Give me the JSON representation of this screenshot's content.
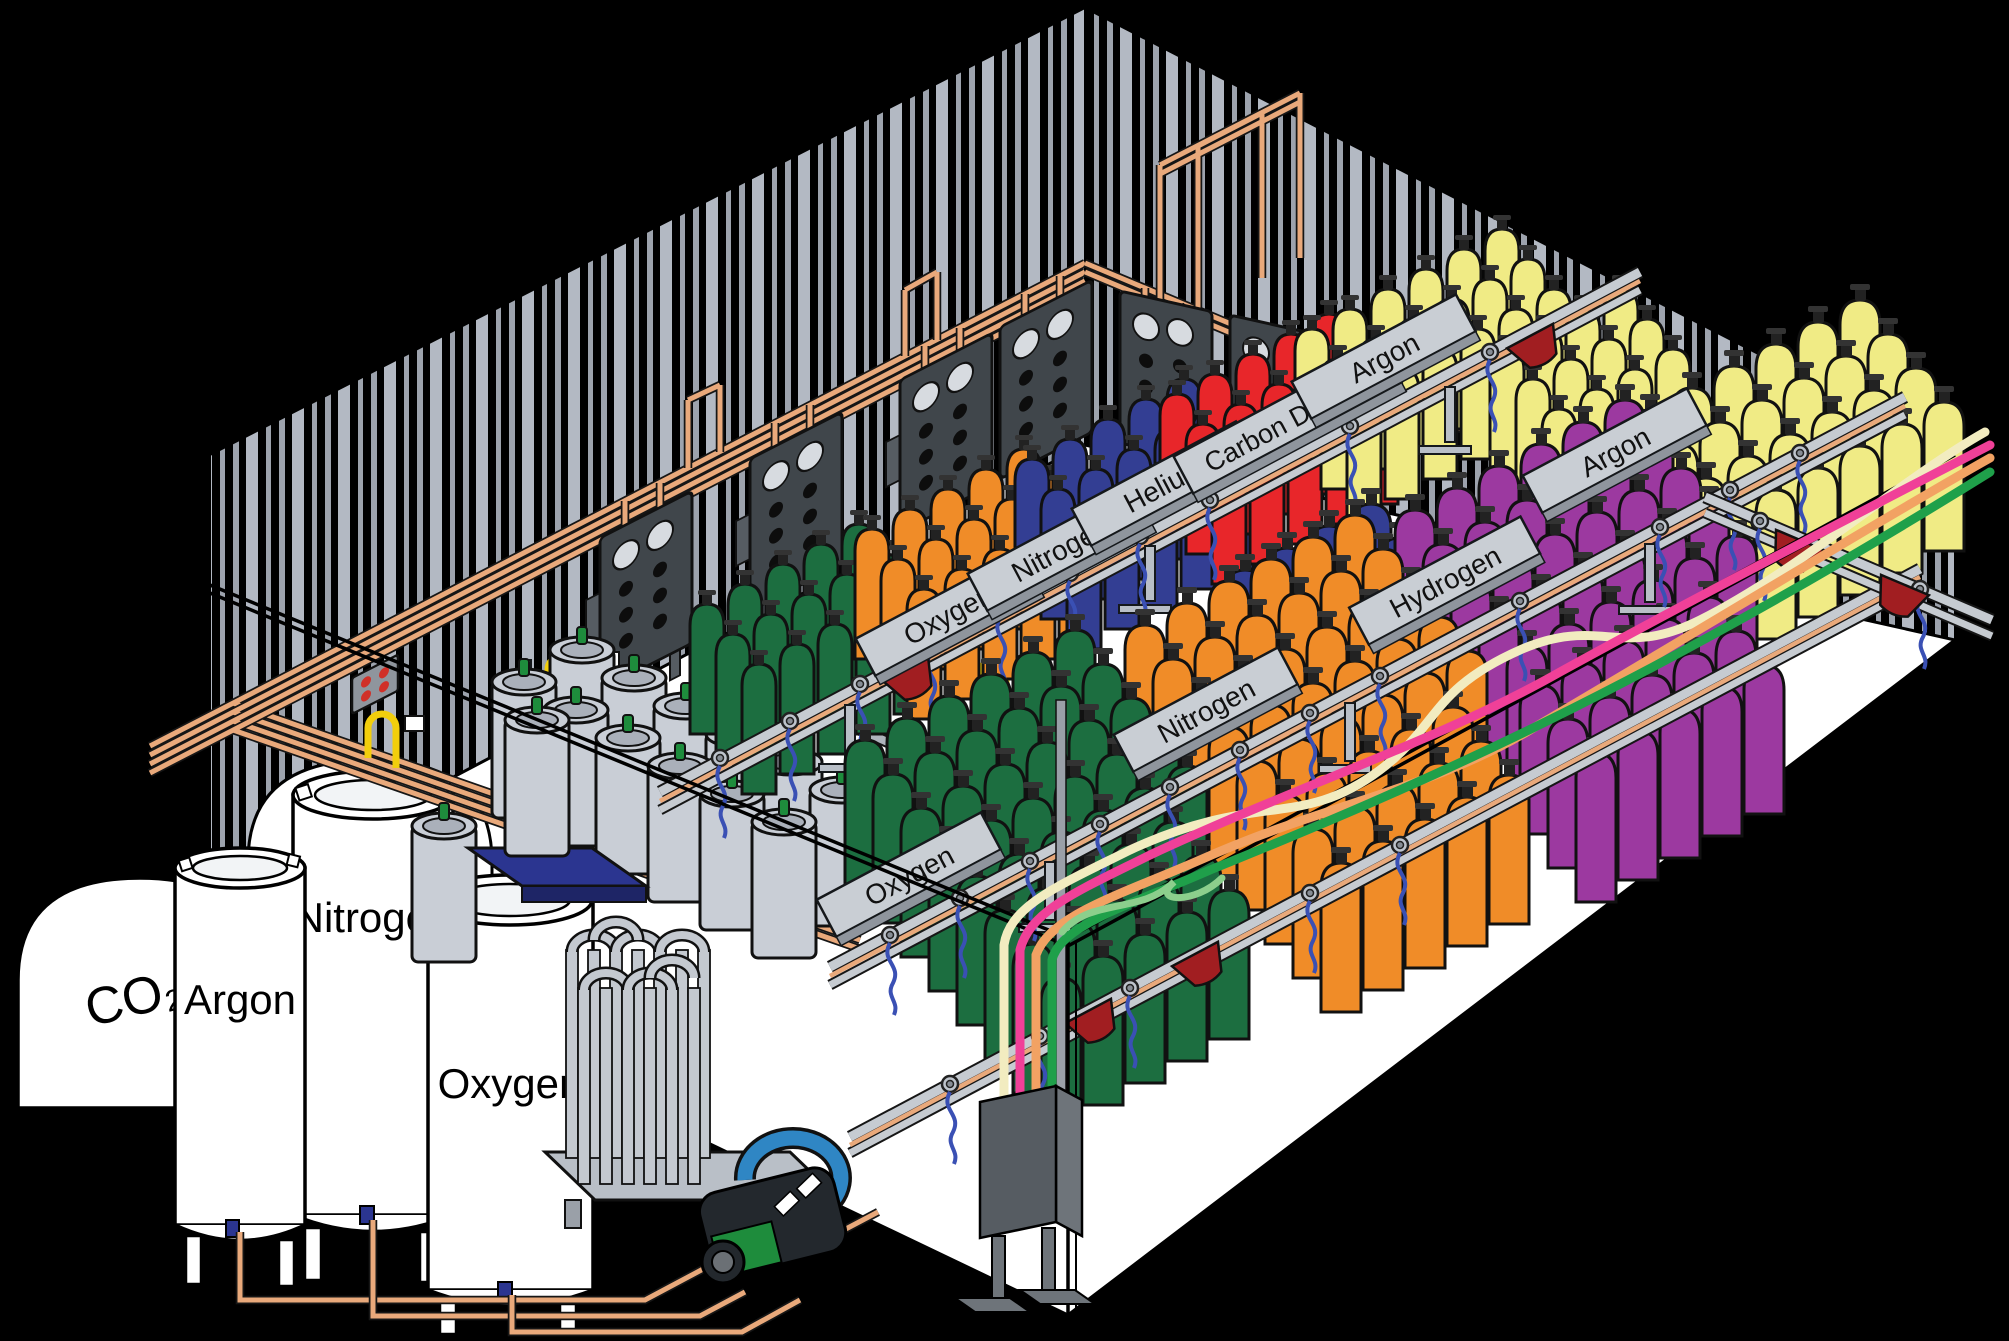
{
  "scene": {
    "description": "Isometric diagram of an industrial gas cylinder filling plant",
    "room": "white floor with corrugated dark walls"
  },
  "storage_tanks": {
    "co2": "CO₂",
    "argon": "Argon",
    "nitrogen": "Nitrogen",
    "oxygen": "Oxygen"
  },
  "signs": {
    "back": [
      "Oxygen",
      "Nitrogen",
      "Helium",
      "Carbon Dioxide",
      "Argon"
    ],
    "front": [
      "Oxygen",
      "Nitrogen",
      "Hydrogen",
      "Argon"
    ]
  },
  "cylinder_groups": [
    {
      "color_name": "dark-green",
      "rows": "oxygen sections"
    },
    {
      "color_name": "orange",
      "rows": "nitrogen sections"
    },
    {
      "color_name": "dark-blue",
      "rows": "nitrogen rack"
    },
    {
      "color_name": "red",
      "rows": "helium rack"
    },
    {
      "color_name": "pale-yellow",
      "rows": "carbon dioxide / argon racks"
    },
    {
      "color_name": "purple",
      "rows": "hydrogen rack"
    }
  ],
  "colors": {
    "copper": "#E9A97B",
    "rail": "#C6CBD1",
    "cyl_green": "#1C6E40",
    "cyl_orange": "#F08C28",
    "cyl_blue": "#333E93",
    "cyl_red": "#E8262A",
    "cyl_yellow": "#F0EB85",
    "cyl_purple": "#9C39A0",
    "hose_blue": "#3A50B4",
    "hose_pink": "#F04098",
    "hose_cream": "#F2ECC0",
    "hose_orange": "#F2A263",
    "hose_green": "#1FA04A",
    "hose_lightgreen": "#8CCF8C",
    "cart_red": "#A11E21",
    "dewar": "#C9CED6",
    "cap_green": "#1E8C3C",
    "pigtail_yellow": "#F2CE0C",
    "panel_dark": "#40464B",
    "scale_blue": "#2B3590",
    "wall_stripe_a": "#9DA3AD",
    "wall_stripe_b": "#B3B9C3",
    "floor": "#FFFFFF"
  }
}
